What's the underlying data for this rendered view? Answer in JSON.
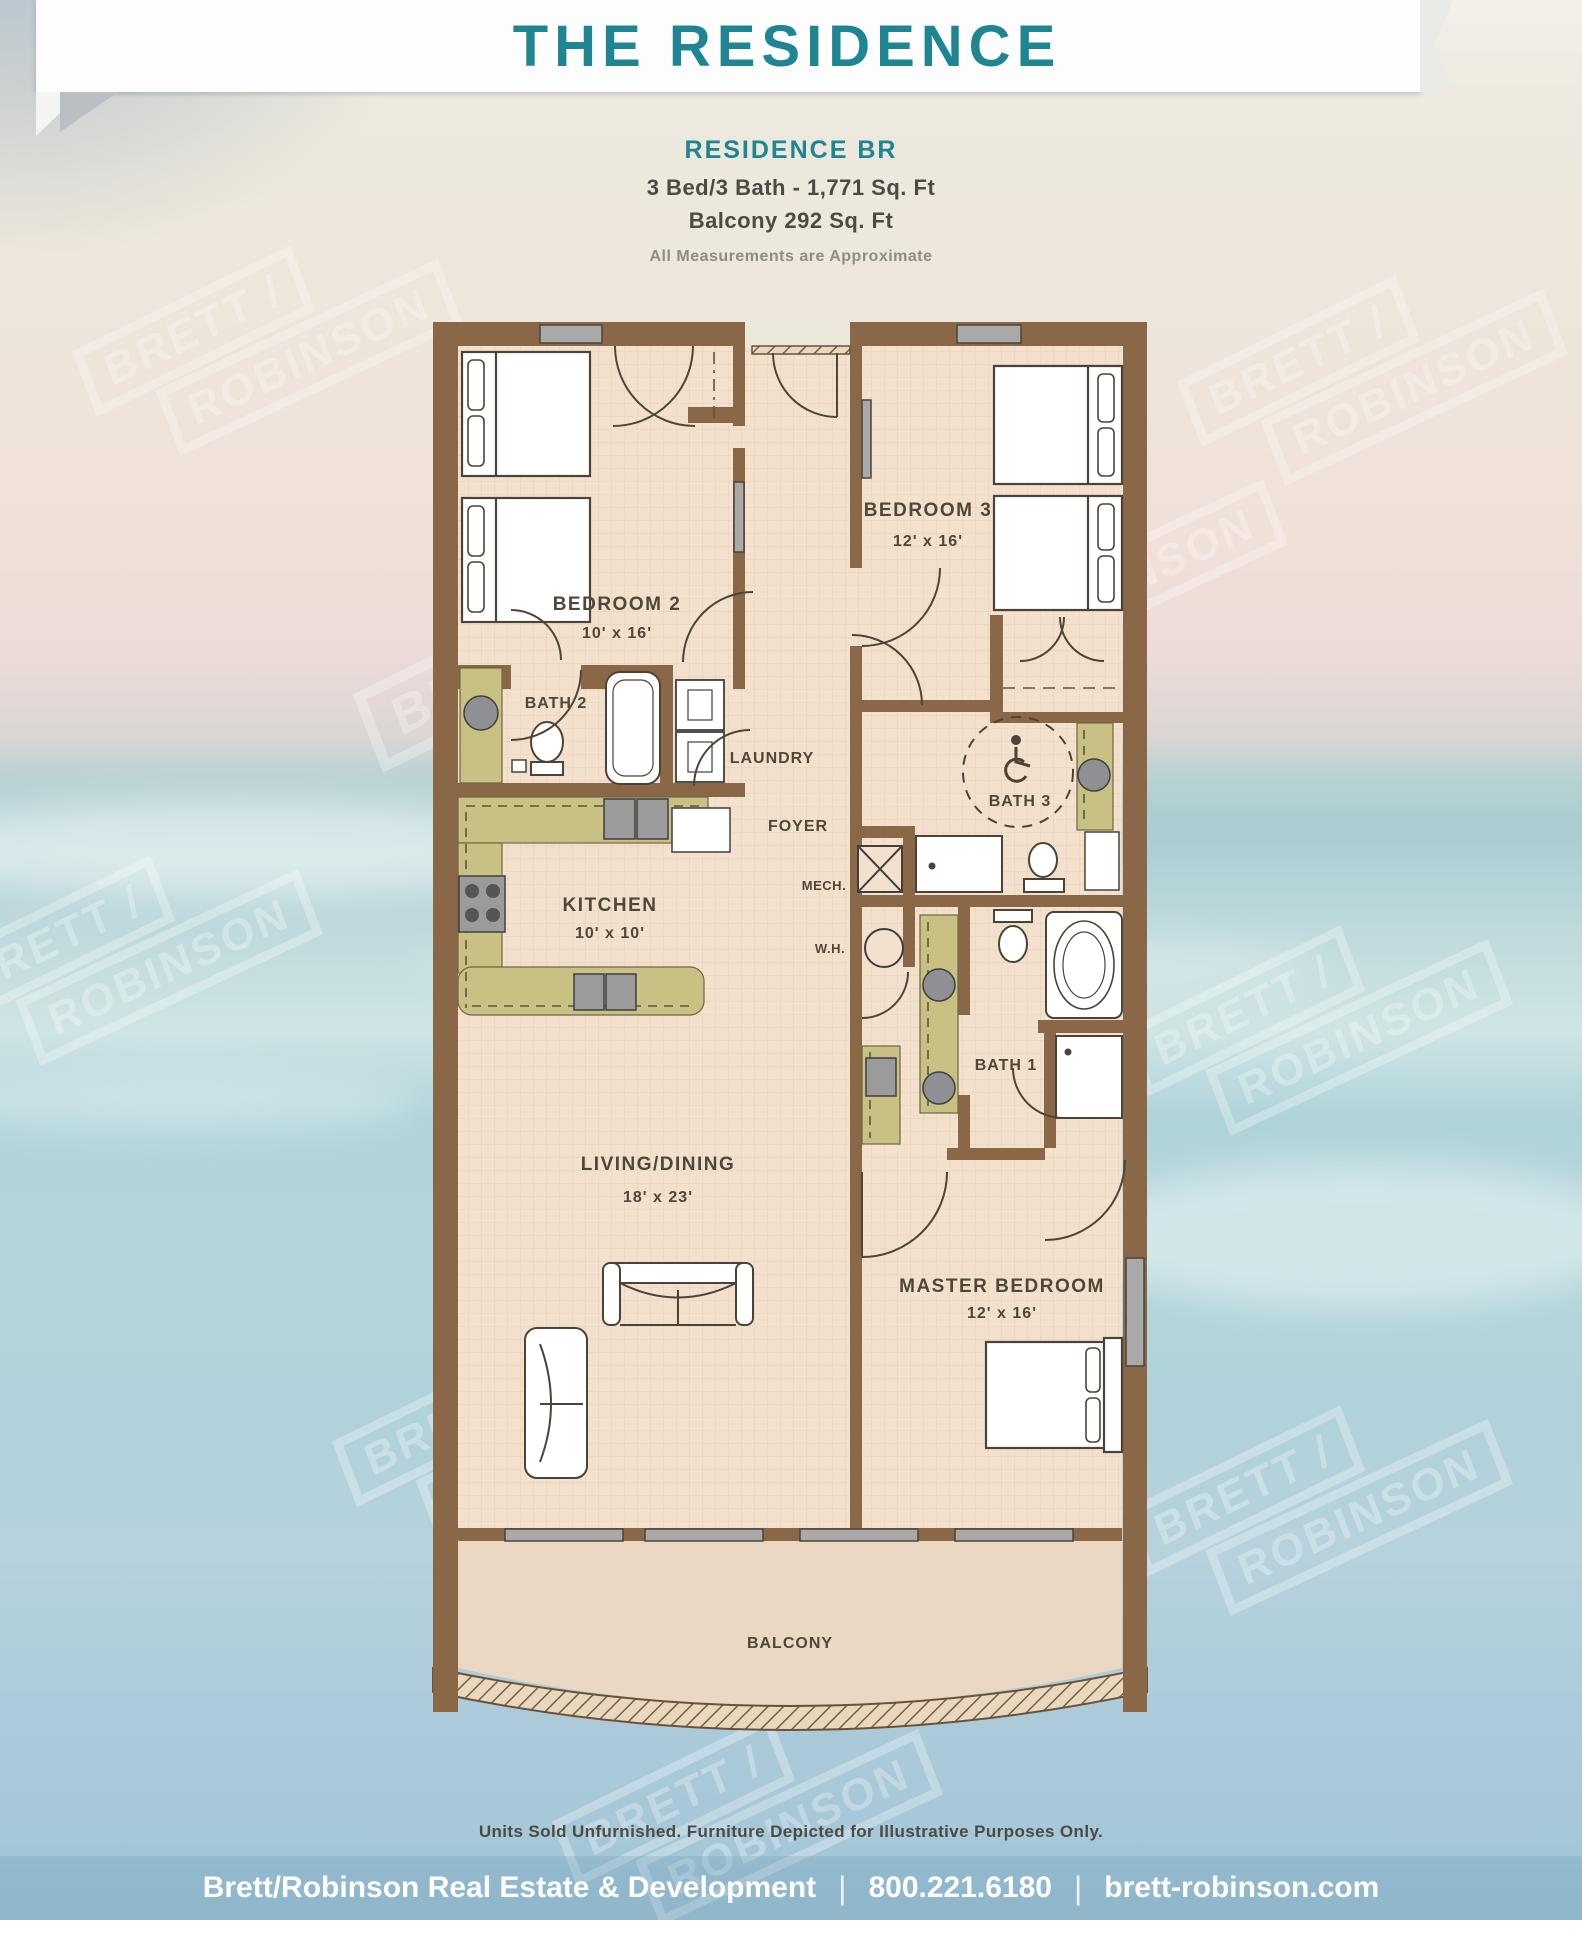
{
  "watermark": {
    "line1": "BRETT /",
    "line2": "ROBINSON"
  },
  "header": {
    "title": "THE RESIDENCE"
  },
  "plan_info": {
    "name": "RESIDENCE BR",
    "specs": "3 Bed/3 Bath - 1,771 Sq. Ft",
    "balcony": "Balcony 292 Sq. Ft",
    "note": "All Measurements are Approximate"
  },
  "floor_plan": {
    "rooms": {
      "bedroom2": {
        "label": "BEDROOM 2",
        "dims": "10' x 16'"
      },
      "bedroom3": {
        "label": "BEDROOM 3",
        "dims": "12' x 16'"
      },
      "master": {
        "label": "MASTER BEDROOM",
        "dims": "12' x 16'"
      },
      "living": {
        "label": "LIVING/DINING",
        "dims": "18' x 23'"
      },
      "kitchen": {
        "label": "KITCHEN",
        "dims": "10' x 10'"
      },
      "bath1": {
        "label": "BATH 1"
      },
      "bath2": {
        "label": "BATH 2"
      },
      "bath3": {
        "label": "BATH 3"
      },
      "laundry": {
        "label": "LAUNDRY"
      },
      "foyer": {
        "label": "FOYER"
      },
      "mech": {
        "label": "MECH."
      },
      "water_heater": {
        "label": "W.H."
      },
      "balcony": {
        "label": "BALCONY"
      }
    }
  },
  "footer": {
    "disclaimer": "Units Sold Unfurnished. Furniture Depicted for Illustrative Purposes Only.",
    "company": "Brett/Robinson Real Estate & Development",
    "phone": "800.221.6180",
    "website": "brett-robinson.com",
    "separator": "|"
  },
  "colors": {
    "accent_teal": "#1f8593",
    "wall_brown": "#8a6847",
    "floor_peach": "#f3e1cd",
    "counter_olive": "#c9c183",
    "footer_text": "#ffffff"
  }
}
